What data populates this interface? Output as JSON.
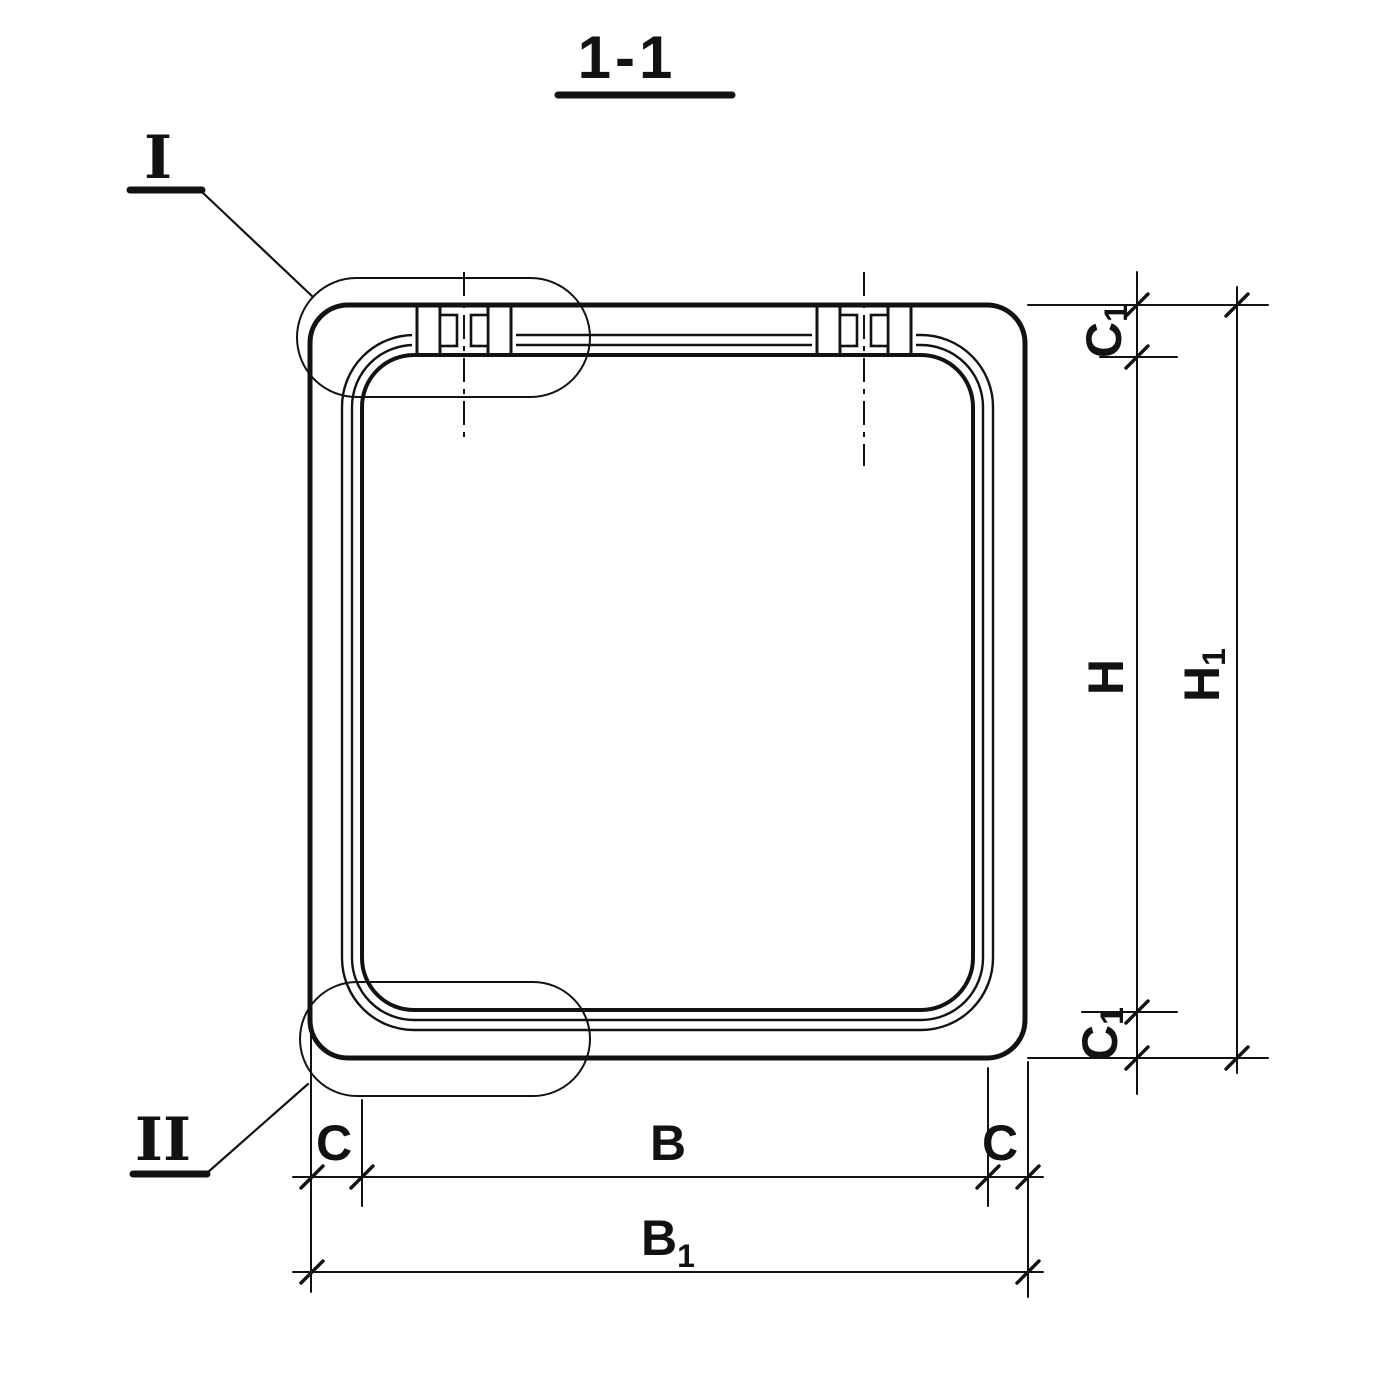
{
  "title": {
    "section_label": "1-1"
  },
  "details": {
    "top_left_callout": "I",
    "bottom_left_callout": "II"
  },
  "dimensions": {
    "c1_top": {
      "base": "C",
      "sub": "1"
    },
    "h": {
      "base": "H",
      "sub": ""
    },
    "h1": {
      "base": "H",
      "sub": "1"
    },
    "c1_bottom": {
      "base": "C",
      "sub": "1"
    },
    "c_left": {
      "base": "C",
      "sub": ""
    },
    "b": {
      "base": "B",
      "sub": ""
    },
    "c_right": {
      "base": "C",
      "sub": ""
    },
    "b1": {
      "base": "B",
      "sub": "1"
    }
  },
  "colors": {
    "ink": "#121212",
    "paper": "#ffffff"
  }
}
